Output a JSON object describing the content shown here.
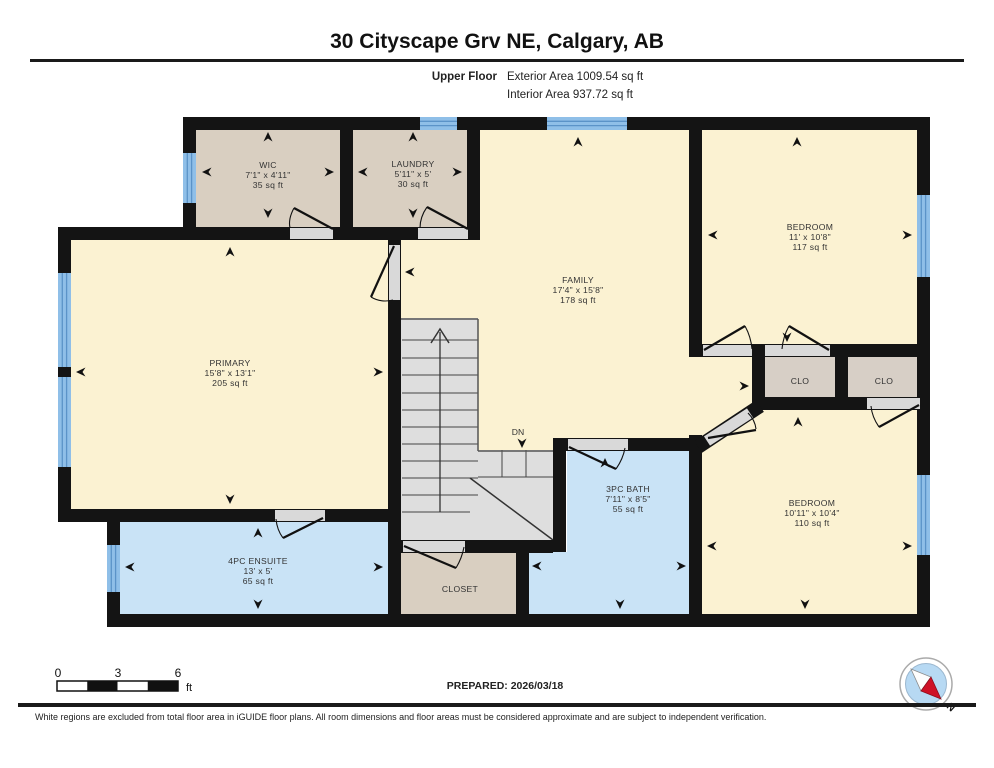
{
  "header": {
    "title": "30 Cityscape Grv NE, Calgary, AB",
    "floor_label": "Upper Floor",
    "exterior_area": "Exterior Area 1009.54 sq ft",
    "interior_area": "Interior Area 937.72 sq ft"
  },
  "rooms": [
    {
      "id": "wic",
      "label": "WIC",
      "dims": "7'1\" x 4'11\"",
      "area": "35 sq ft"
    },
    {
      "id": "laundry",
      "label": "LAUNDRY",
      "dims": "5'11\" x 5'",
      "area": "30 sq ft"
    },
    {
      "id": "family",
      "label": "FAMILY",
      "dims": "17'4\" x 15'8\"",
      "area": "178 sq ft"
    },
    {
      "id": "bedroom1",
      "label": "BEDROOM",
      "dims": "11' x 10'8\"",
      "area": "117 sq ft"
    },
    {
      "id": "primary",
      "label": "PRIMARY",
      "dims": "15'8\" x 13'1\"",
      "area": "205 sq ft"
    },
    {
      "id": "ensuite",
      "label": "4PC ENSUITE",
      "dims": "13' x 5'",
      "area": "65 sq ft"
    },
    {
      "id": "bath",
      "label": "3PC BATH",
      "dims": "7'11\" x 8'5\"",
      "area": "55 sq ft"
    },
    {
      "id": "bedroom2",
      "label": "BEDROOM",
      "dims": "10'11\" x 10'4\"",
      "area": "110 sq ft"
    },
    {
      "id": "closet",
      "label": "CLOSET",
      "dims": "",
      "area": ""
    },
    {
      "id": "clo1",
      "label": "CLO",
      "dims": "",
      "area": ""
    },
    {
      "id": "clo2",
      "label": "CLO",
      "dims": "",
      "area": ""
    }
  ],
  "stairs": {
    "down_label": "DN"
  },
  "scale_bar": {
    "ticks": [
      "0",
      "3",
      "6"
    ],
    "unit": "ft"
  },
  "footer": {
    "prepared": "PREPARED: 2026/03/18",
    "compass_label": "N",
    "disclaimer": "White regions are excluded from total floor area in iGUIDE floor plans. All room dimensions and floor areas must be considered approximate and are subject to independent verification."
  },
  "colors": {
    "cream": "#FBF2D2",
    "tan": "#D9CFC1",
    "clo": "#D7CFC6",
    "blue": "#C9E3F6",
    "stairs": "#DEDEDE",
    "wall": "#141414",
    "threshold": "#D9D9D9",
    "window": "#8FBFE8",
    "window_stripe": "#5B93C8"
  }
}
